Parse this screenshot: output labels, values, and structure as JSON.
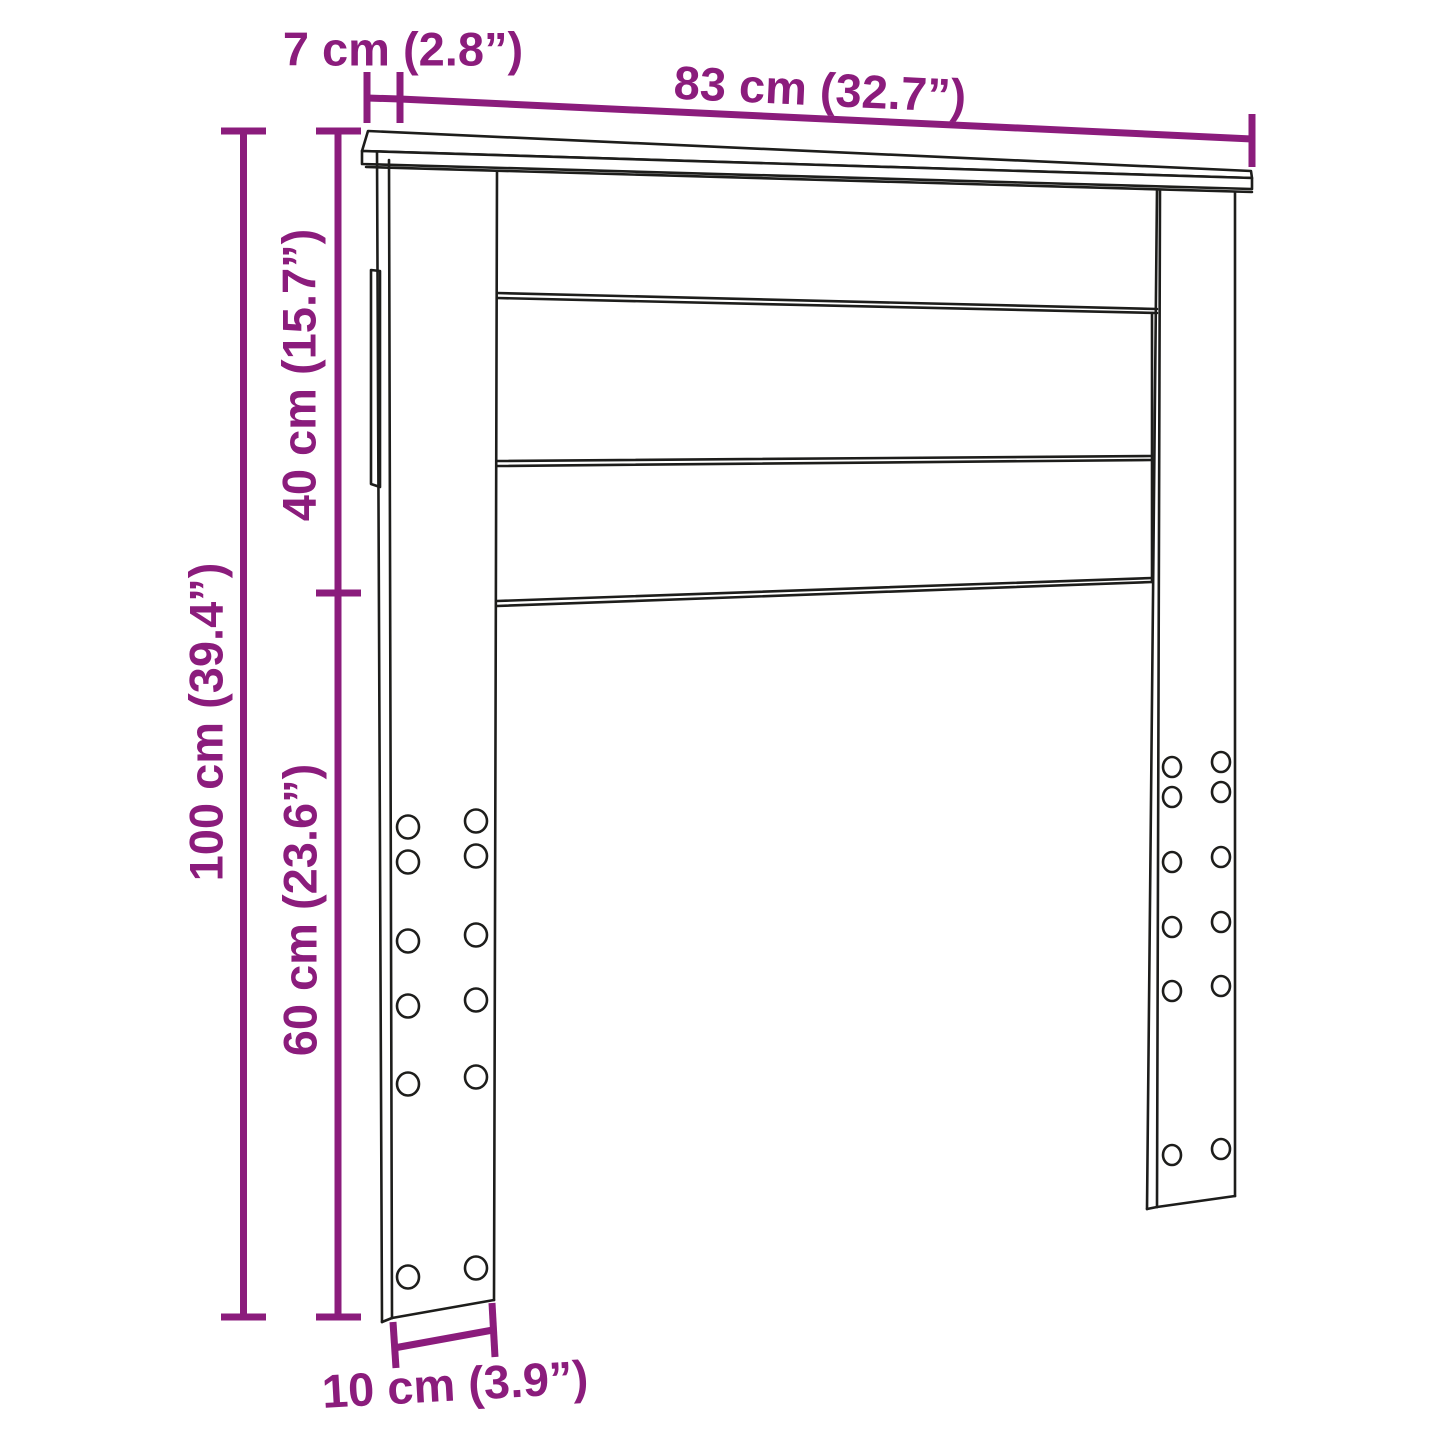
{
  "diagram": {
    "kind": "furniture dimension line drawing",
    "dimensions": {
      "top_small": "7 cm (2.8”)",
      "top_width": "83 cm (32.7”)",
      "height_upper": "40 cm (15.7”)",
      "height_total": "100 cm (39.4”)",
      "height_lower": "60 cm (23.6”)",
      "bottom_width": "10 cm (3.9”)"
    },
    "colors": {
      "dimension_accent": "#8B1C7C",
      "outline": "#1D1D1B",
      "background": "#FFFFFF"
    }
  }
}
